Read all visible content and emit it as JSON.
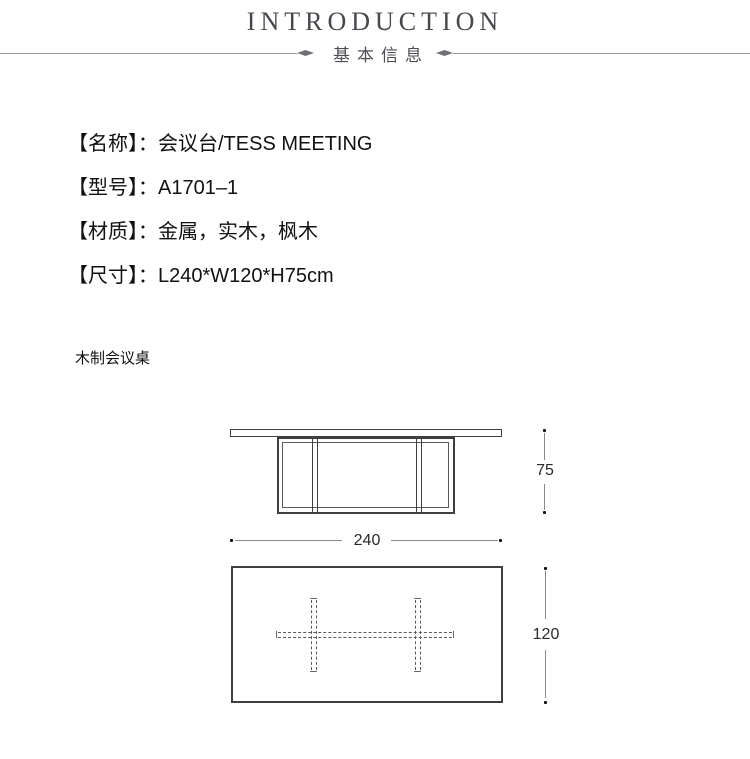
{
  "header": {
    "title": "INTRODUCTION",
    "subtitle": "基本信息"
  },
  "specs": {
    "items": [
      {
        "label": "【名称】",
        "value": "：会议台/TESS MEETING"
      },
      {
        "label": "【型号】",
        "value": "：A1701–1"
      },
      {
        "label": "【材质】",
        "value": "：金属，实木，枫木"
      },
      {
        "label": "【尺寸】",
        "value": "：L240*W120*H75cm"
      }
    ]
  },
  "caption": "木制会议桌",
  "diagram": {
    "height_dim": "75",
    "width_dim": "240",
    "depth_dim": "120"
  },
  "colors": {
    "header_text": "#47474d",
    "divider_line": "#9a9a9a",
    "drawing_line": "#3f3f3f",
    "dimension_line": "#8a8a8a",
    "body_text": "#111111"
  }
}
